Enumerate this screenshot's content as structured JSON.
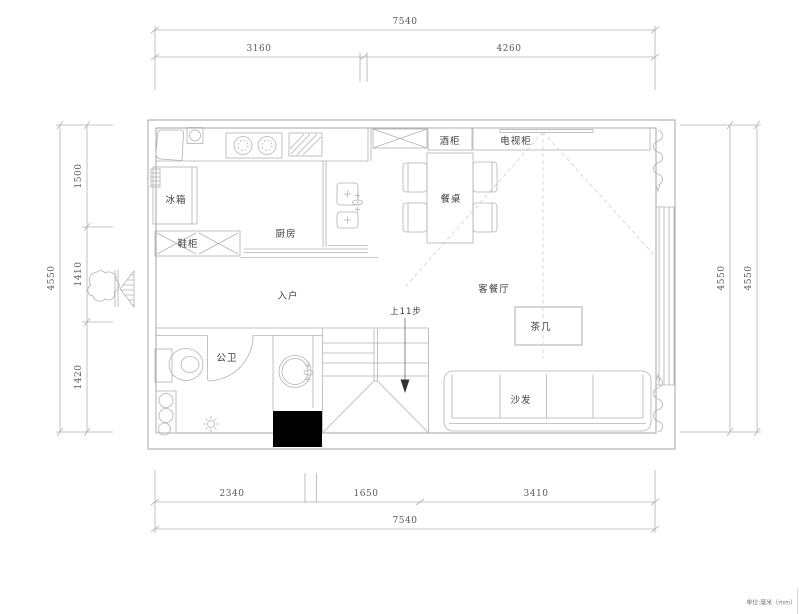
{
  "title": "apartment-floor-plan",
  "labels": {
    "kitchen": "厨房",
    "entry": "入户",
    "living_dining": "客餐厅",
    "bathroom": "公卫",
    "fridge": "冰箱",
    "shoe_cabinet": "鞋柜",
    "wine_cabinet": "酒柜",
    "tv_cabinet": "电视柜",
    "dining_table": "餐桌",
    "coffee_table": "茶几",
    "sofa": "沙发",
    "stairs": "上11步",
    "units_note": "单位:毫米（mm）"
  },
  "dimensions": {
    "top": {
      "total": "7540",
      "seg1": "3160",
      "seg2": "4260"
    },
    "bottom": {
      "seg1": "2340",
      "seg2": "1650",
      "seg3": "3410",
      "total": "7540"
    },
    "left": {
      "total": "4550",
      "seg1": "1500",
      "seg2": "1410",
      "seg3": "1420"
    },
    "right": {
      "outer": "4550",
      "inner": "4550"
    }
  },
  "colors": {
    "line": "#b3b3b3",
    "wall": "#a6a6a6",
    "dashed": "#d0d0d0",
    "text": "#3f3f3f",
    "dim_text": "#5a5a5a",
    "column_fill": "#000000",
    "background": "#ffffff"
  }
}
